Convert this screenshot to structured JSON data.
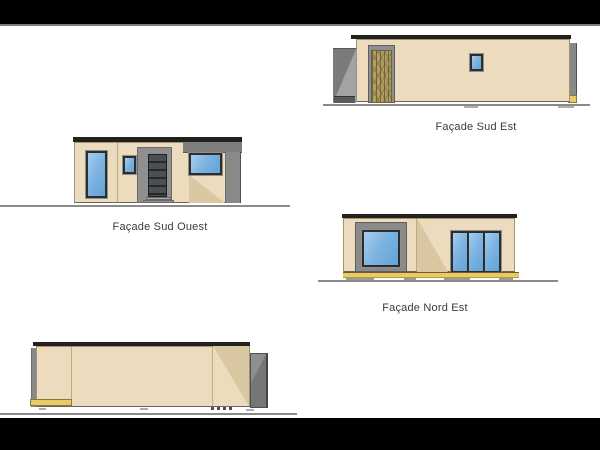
{
  "canvas": {
    "background": "#ffffff",
    "letterbox_color": "#000000",
    "letterbox_separator_color": "#7d7d7d"
  },
  "palette": {
    "wall_cream": "#ecdcbd",
    "wall_shadow": "#d9c7a2",
    "roof_dark": "#23211e",
    "concrete_gray": "#8c8c8c",
    "recess_gray": "#a3a3a3",
    "window_frame_dark": "#2d2d2d",
    "glass_blue": "#7eb4e1",
    "deck_yellow": "#e7cb66",
    "wood_screen_tan": "#b3a05e",
    "ground_line_gray": "#8a8a8a",
    "label_text": "#3b3b3b"
  },
  "drawings": {
    "sud_est": {
      "label": "Façade Sud Est"
    },
    "sud_ouest": {
      "label": "Façade Sud Ouest"
    },
    "nord_est": {
      "label": "Façade Nord Est"
    },
    "nord_ouest": {
      "label": ""
    }
  }
}
